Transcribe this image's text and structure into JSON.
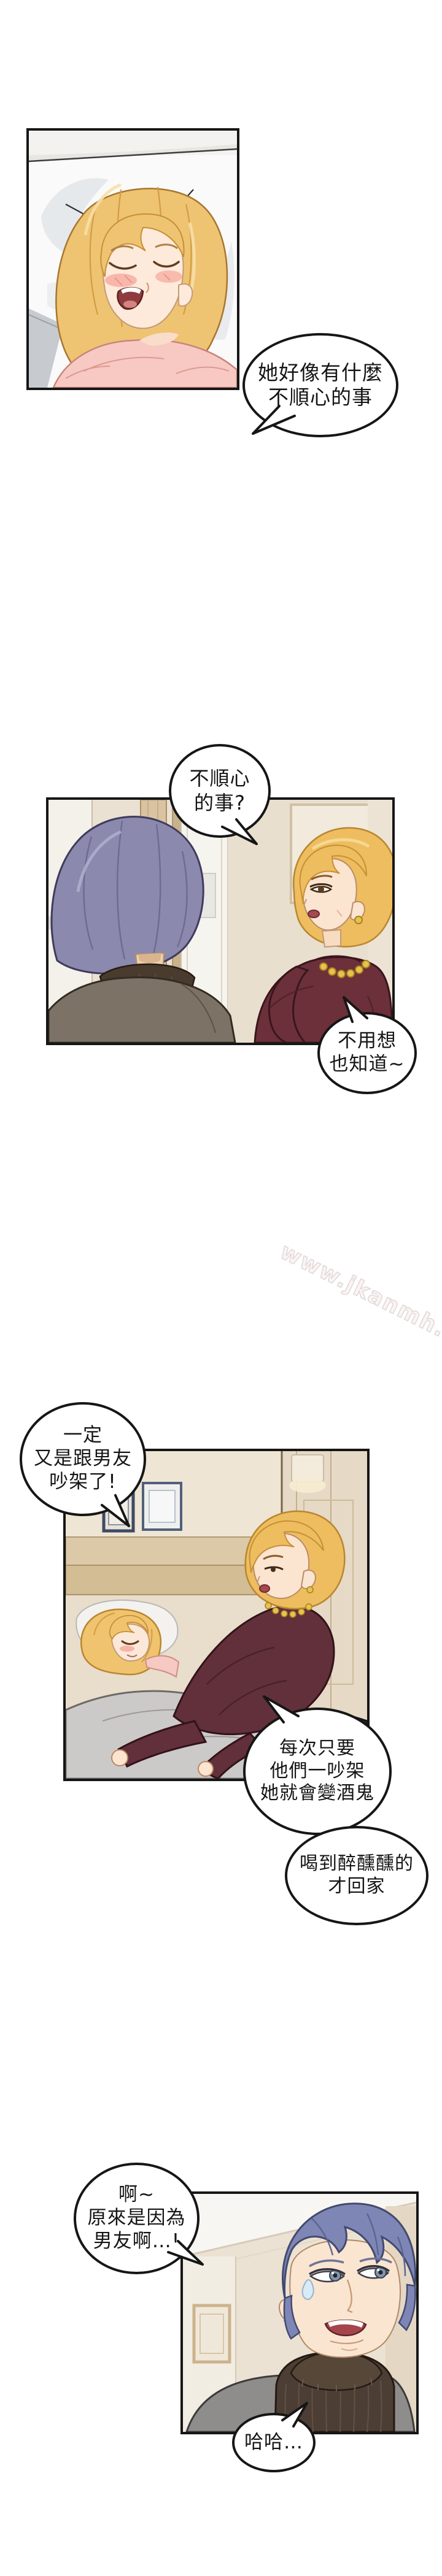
{
  "watermark": {
    "text": "www.jkanmh.top",
    "color": "#e4d8d8"
  },
  "bubbles": [
    {
      "name": "bubble-1",
      "lines": [
        "她好像有什麼",
        "不順心的事"
      ]
    },
    {
      "name": "bubble-2",
      "lines": [
        "不順心",
        "的事?"
      ]
    },
    {
      "name": "bubble-3",
      "lines": [
        "不用想",
        "也知道~"
      ]
    },
    {
      "name": "bubble-4",
      "lines": [
        "一定",
        "又是跟男友",
        "吵架了!"
      ]
    },
    {
      "name": "bubble-5",
      "lines": [
        "每次只要",
        "他們一吵架",
        "她就會變酒鬼"
      ]
    },
    {
      "name": "bubble-6",
      "lines": [
        "喝到醉醺醺的",
        "才回家"
      ]
    },
    {
      "name": "bubble-7",
      "lines": [
        "啊~",
        "原來是因為",
        "男友啊…!"
      ]
    },
    {
      "name": "bubble-8",
      "lines": [
        "哈哈…"
      ]
    }
  ],
  "palette": {
    "page_background": "#ffffff",
    "panel_border": "#161616",
    "bubble_border": "#161616",
    "blonde_hair": "#eec473",
    "purple_gray_hair": "#8b89ad",
    "blue_purple_hair": "#7e86b6",
    "burgundy_sweater": "#6b3039",
    "dark_turtleneck": "#4c3e34",
    "gray_jacket": "#8f8d8b",
    "pink_top": "#f7c9c2",
    "gray_blanket": "#cccac8",
    "beige_wall": "#eae1d2",
    "gold_necklace": "#e7c24f"
  }
}
